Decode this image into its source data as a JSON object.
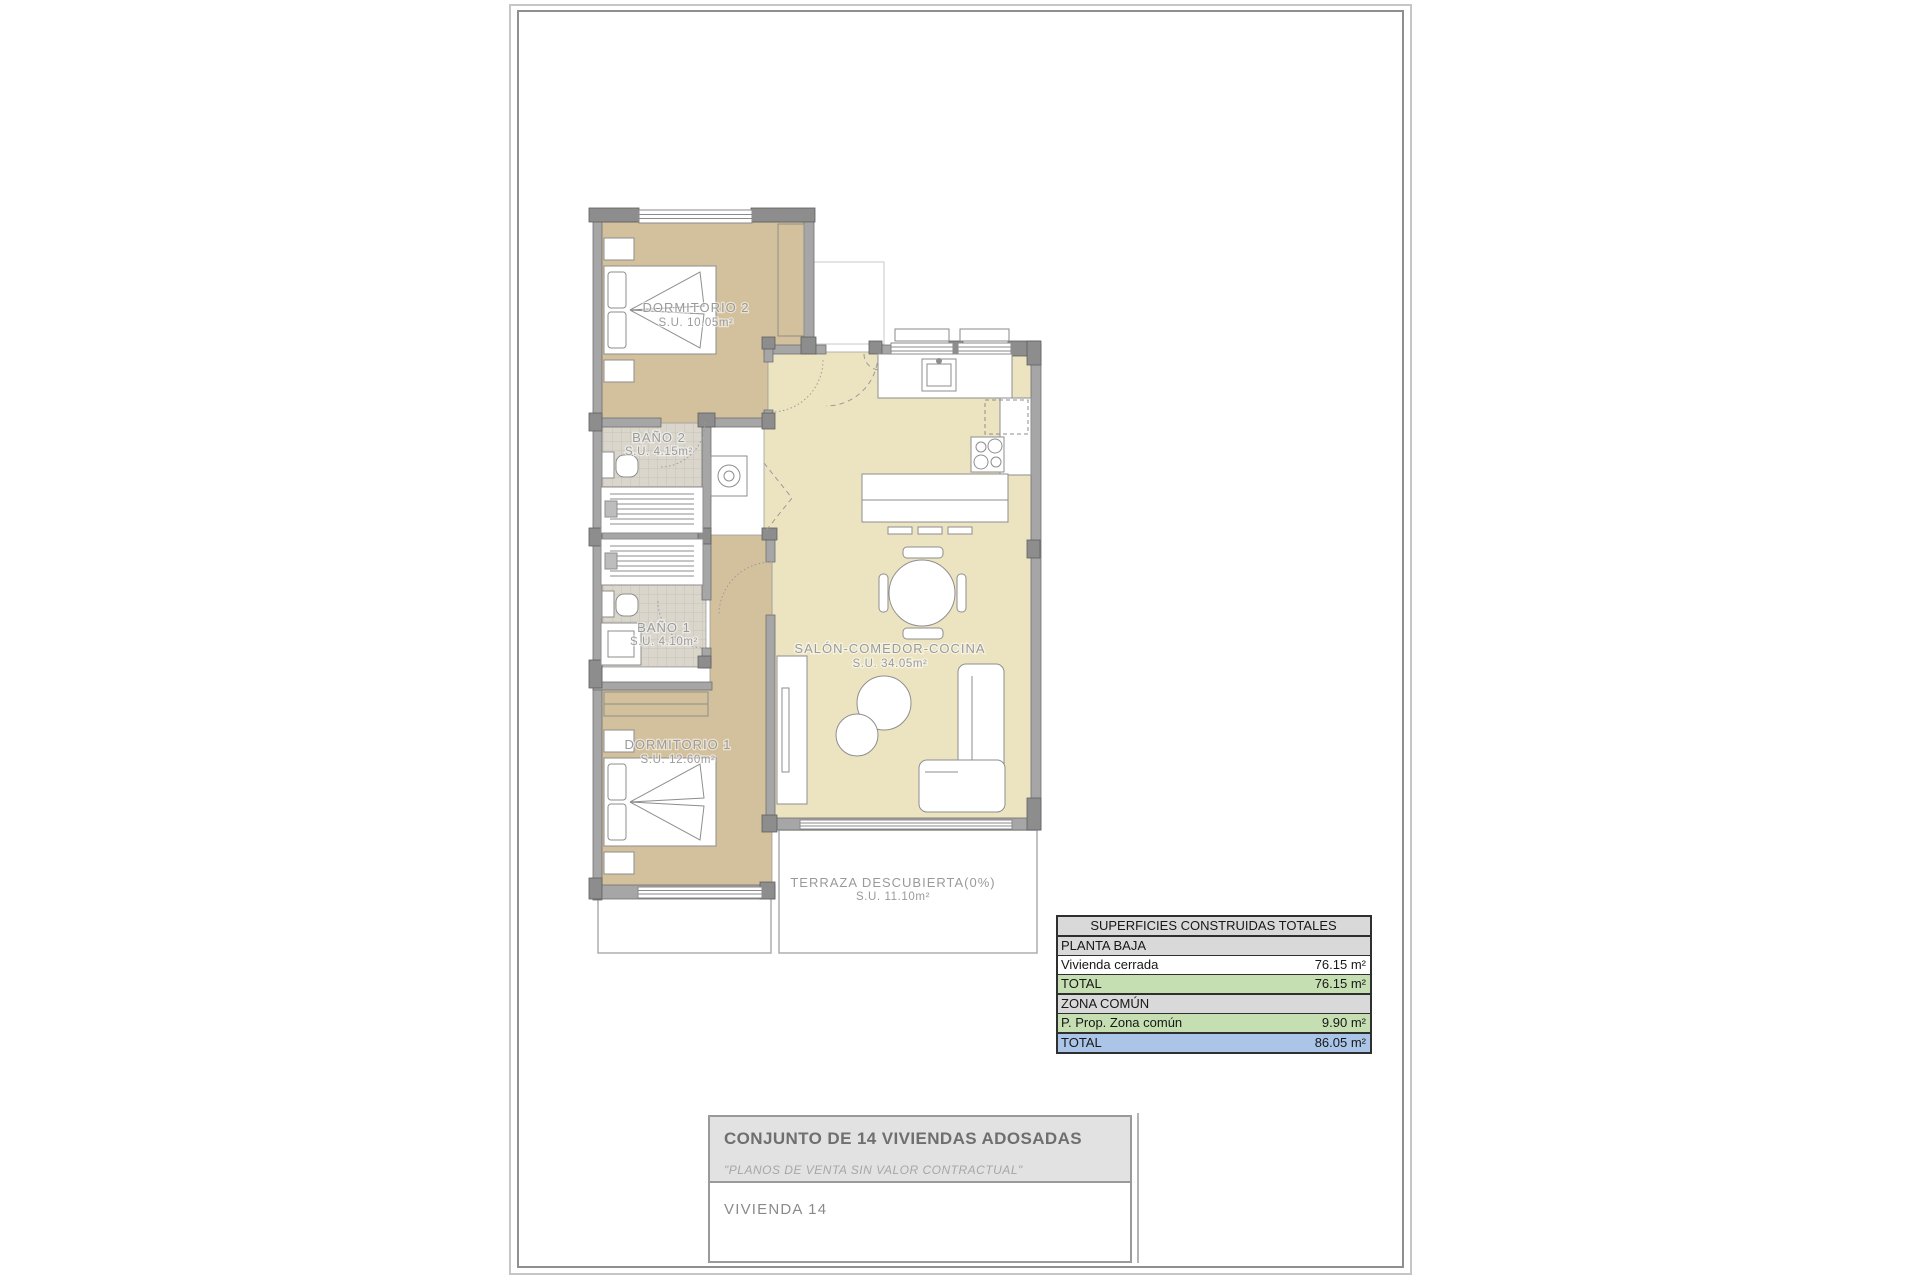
{
  "sheet": {
    "background": "#ffffff",
    "frame_outer_color": "#c6c6c6",
    "frame_inner_color": "#8f8f8f"
  },
  "plan": {
    "label_color": "#9a9a9a",
    "colors": {
      "bedroom_fill": "#d3c09c",
      "living_fill": "#ece4c1",
      "bath_tile": "#dad6cb",
      "wall": "#a6a6a6",
      "wall_dark": "#8d8d8d",
      "furniture_line": "#8e8e8e"
    },
    "rooms": [
      {
        "id": "dormitorio-2",
        "name": "DORMITORIO 2",
        "area": "S.U. 10.05m²"
      },
      {
        "id": "bano-2",
        "name": "BAÑO 2",
        "area": "S.U. 4.15m²"
      },
      {
        "id": "bano-1",
        "name": "BAÑO 1",
        "area": "S.U. 4.10m²"
      },
      {
        "id": "dormitorio-1",
        "name": "DORMITORIO 1",
        "area": "S.U. 12.60m²"
      },
      {
        "id": "salon-comedor-cocina",
        "name": "SALÓN-COMEDOR-COCINA",
        "area": "S.U. 34.05m²"
      },
      {
        "id": "terraza",
        "name": "TERRAZA DESCUBIERTA(0%)",
        "area": "S.U. 11.10m²"
      }
    ]
  },
  "areas_table": {
    "title": "SUPERFICIES CONSTRUIDAS TOTALES",
    "rows": [
      {
        "label": "PLANTA BAJA",
        "value": ""
      },
      {
        "label": "Vivienda cerrada",
        "value": "76.15 m²"
      },
      {
        "label": "TOTAL",
        "value": "76.15 m²"
      },
      {
        "label": "ZONA COMÚN",
        "value": ""
      },
      {
        "label": "P. Prop. Zona común",
        "value": "9.90 m²"
      },
      {
        "label": "TOTAL",
        "value": "86.05 m²"
      }
    ],
    "colors": {
      "header_bg": "#d9d9d9",
      "section_bg": "#d9d9d9",
      "total_green_bg": "#c5dfb3",
      "total_blue_bg": "#abc5e8",
      "border": "#2f2f2f"
    }
  },
  "title_block": {
    "project_title": "CONJUNTO DE 14 VIVIENDAS ADOSADAS",
    "disclaimer": "\"PLANOS DE VENTA SIN VALOR CONTRACTUAL\"",
    "unit_label": "VIVIENDA 14"
  }
}
